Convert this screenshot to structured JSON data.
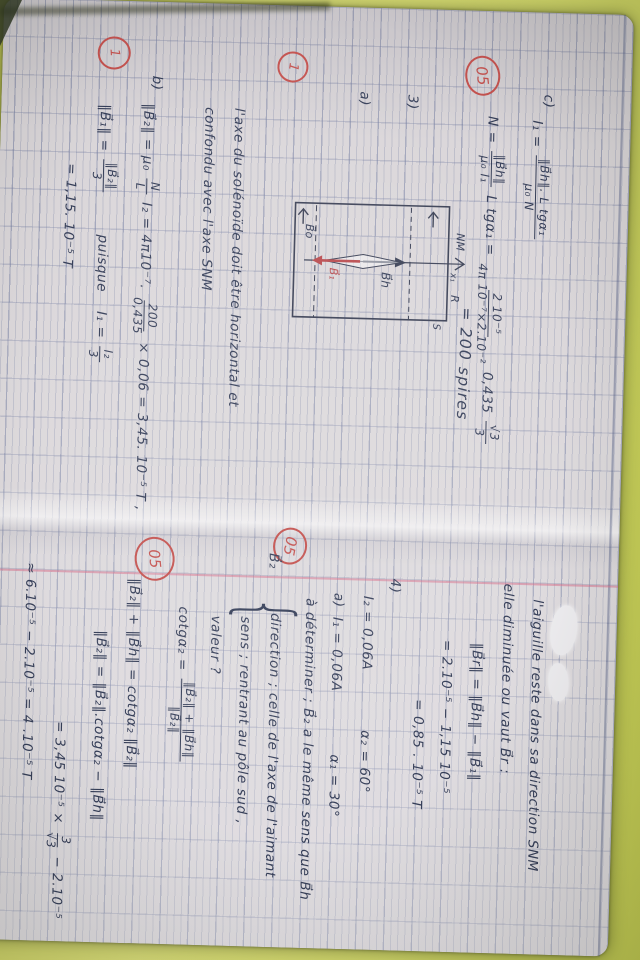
{
  "colors": {
    "background": "#d3d96b",
    "paper": "#dad6d9",
    "ink": "#353e58",
    "red_marks": "#c4524f",
    "margin_line": "#d86c88"
  },
  "grades": {
    "top": "05",
    "mid": "05",
    "low": "05",
    "one_a": "1",
    "one_b": "1"
  },
  "left": {
    "c_label": "c)",
    "i1": {
      "pre": "I₁ =",
      "num": "‖B⃗h‖. L tgα₁",
      "den": "μ₀ N"
    },
    "n": {
      "pre": "N =",
      "num1": "‖B⃗h‖",
      "den1": "μ₀ I₁",
      "mid": "L tgα₁ =",
      "num2": "2 10⁻⁵",
      "den2": "4π 10⁻⁷×2.10⁻²",
      "factor": "0,435",
      "num3": "√3",
      "den3": "3"
    },
    "n_result": "= 200 spires",
    "q3_label": "3)",
    "qa_label": "a)",
    "note1": "l'axe du solénoïde doit être horizontal et",
    "note2": "confondu avec l'axe SNM",
    "b_label": "b)",
    "b1": {
      "pre": "‖B⃗₂‖ = μ₀",
      "num1": "N",
      "den1": "L",
      "mid": "I₂ = 4π10⁻⁷.",
      "num2": "200",
      "den2": "0,435",
      "post": "× 0,06 = 3,45. 10⁻⁵ T ,"
    },
    "b2": {
      "pre": "‖B⃗₁‖ =",
      "num": "‖B⃗₂‖",
      "den": "3",
      "note": "puisque",
      "note2": "I₁ =",
      "num2": "I₂",
      "den2": "3"
    },
    "b3": "= 1,15. 10⁻⁵ T"
  },
  "diagram": {
    "nm": "NM",
    "x1": "x₁",
    "r": "R",
    "s": "S",
    "bh": "B⃗h",
    "b1": "B⃗₁",
    "bo": "B⃗o"
  },
  "right": {
    "l1": "l'aiguille reste dans sa direction SNM",
    "l2": "elle diminuée ou vaut B⃗r :",
    "l3": "‖B⃗r‖ = ‖B⃗h‖ − ‖B⃗₁‖",
    "l4": "= 2.10⁻⁵ − 1,15 10⁻⁵",
    "l5": "= 0,85 . 10⁻⁵ T",
    "q4_label": "4)",
    "i2": "I₂ = 0,06A",
    "a2": "α₂ = 60°",
    "qa_label": "a)",
    "i1": "I₁ = 0,06A",
    "a1": "α₁ = 30°",
    "det": "à déterminer ; B⃗₂ a le même sens que B⃗h",
    "b2_vec": "B⃗₂",
    "brace": "{",
    "dir": "direction ; celle de l'axe de l'aimant",
    "sens": "sens ; rentrant au pôle sud ,",
    "val": "valeur    ?",
    "ct": {
      "pre": "cotgα₂ =",
      "num": "‖B⃗₂‖ + ‖B⃗h‖",
      "den": "‖B⃗₂‖"
    },
    "eq1": "‖B⃗₂‖ + ‖B⃗h‖ = cotgα₂ ‖B⃗₂‖",
    "eq2": "‖B⃗₂‖ = ‖B⃗₂‖.cotgα₂ − ‖B⃗h‖",
    "eq3": {
      "pre": "= 3,45 10⁻⁵ ×",
      "num": "3",
      "den": "√3",
      "post": "− 2.10⁻⁵"
    },
    "eq4": "≈ 6.10⁻⁵ − 2.10⁻⁵ = 4 .10⁻⁵ T"
  }
}
